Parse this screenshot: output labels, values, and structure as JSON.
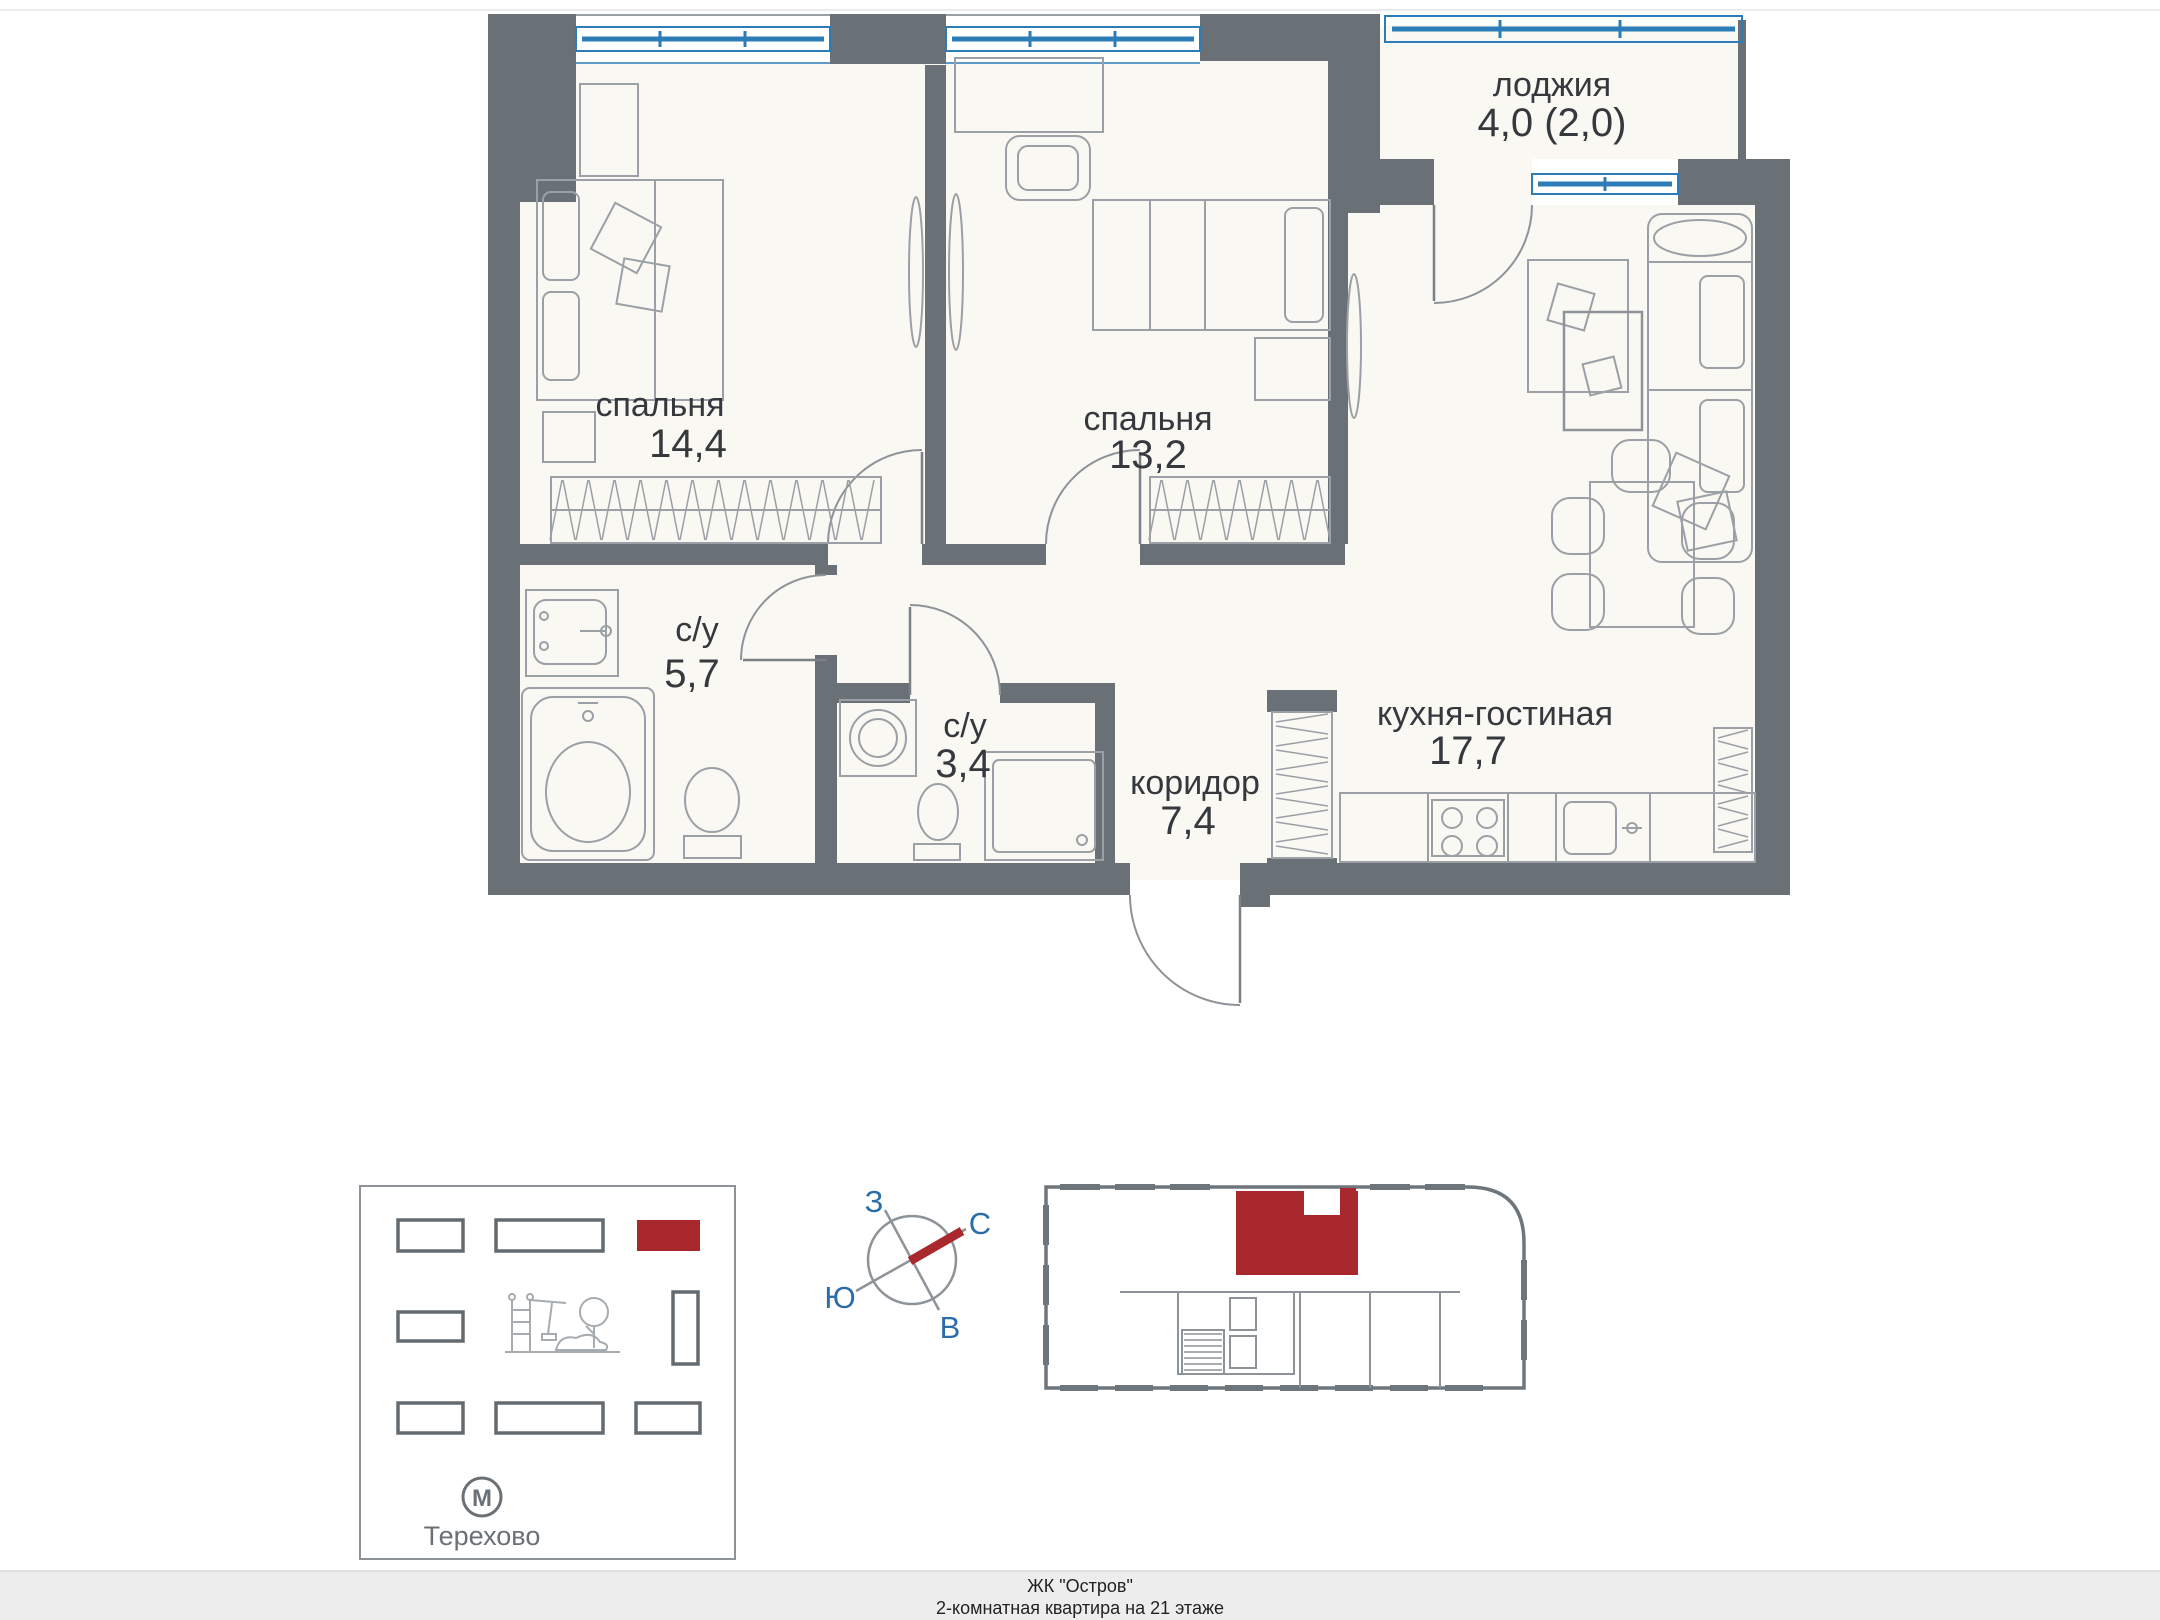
{
  "floor_plan": {
    "rooms": [
      {
        "id": "bedroom-1",
        "name": "спальня",
        "area": "14,4"
      },
      {
        "id": "bedroom-2",
        "name": "спальня",
        "area": "13,2"
      },
      {
        "id": "loggia",
        "name": "лоджия",
        "area": "4,0 (2,0)"
      },
      {
        "id": "bathroom-1",
        "name": "с/у",
        "area": "5,7"
      },
      {
        "id": "bathroom-2",
        "name": "с/у",
        "area": "3,4"
      },
      {
        "id": "corridor",
        "name": "коридор",
        "area": "7,4"
      },
      {
        "id": "kitchen-living",
        "name": "кухня-гостиная",
        "area": "17,7"
      }
    ]
  },
  "compass": {
    "west": "З",
    "north": "С",
    "south": "Ю",
    "east": "В"
  },
  "site_plan": {
    "metro_letter": "М",
    "metro_name": "Терехово"
  },
  "footer": {
    "line1": "ЖК \"Остров\"",
    "line2": "2-комнатная квартира на 21 этаже"
  },
  "colors": {
    "wall": "#6a7176",
    "window_blue": "#2c7cb7",
    "accent_red": "#a9282d",
    "floor": "#f9f8f2",
    "furniture_line": "#9aa0a5",
    "label_text": "#35393d",
    "compass_blue": "#2b6da8",
    "footer_bg": "#ededed"
  }
}
